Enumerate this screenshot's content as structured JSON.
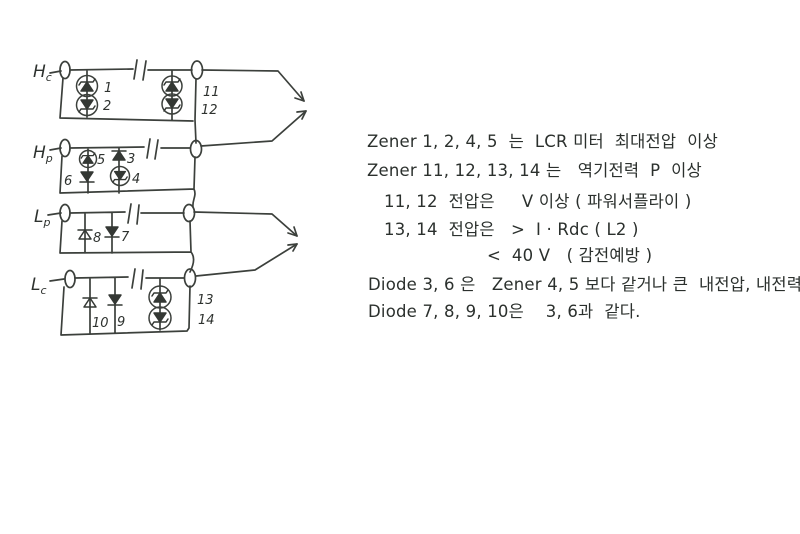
{
  "circuit": {
    "rows": {
      "hc": {
        "main": "H",
        "sub": "c"
      },
      "hp": {
        "main": "H",
        "sub": "p"
      },
      "lp": {
        "main": "L",
        "sub": "p"
      },
      "lc": {
        "main": "L",
        "sub": "c"
      }
    },
    "components": {
      "z1": "1",
      "z2": "2",
      "z11": "11",
      "z12": "12",
      "z5": "5",
      "d6": "6",
      "d3": "3",
      "z4": "4",
      "d8": "8",
      "d7": "7",
      "d10": "10",
      "d9": "9",
      "z13": "13",
      "z14": "14"
    }
  },
  "notes": {
    "line1": "Zener 1, 2, 4, 5  는  LCR 미터  최대전압  이상",
    "line2": "Zener 11, 12, 13, 14 는   역기전력  P  이상",
    "line3": "11, 12  전압은     V 이상 ( 파워서플라이 )",
    "line4": "13, 14  전압은   >  I · Rdc ( L2 )",
    "line5": "<  40 V   ( 감전예방 )",
    "line6": "Diode 3, 6 은   Zener 4, 5 보다 같거나 큰  내전압, 내전력",
    "line7": "Diode 7, 8, 9, 10은    3, 6과  같다."
  }
}
